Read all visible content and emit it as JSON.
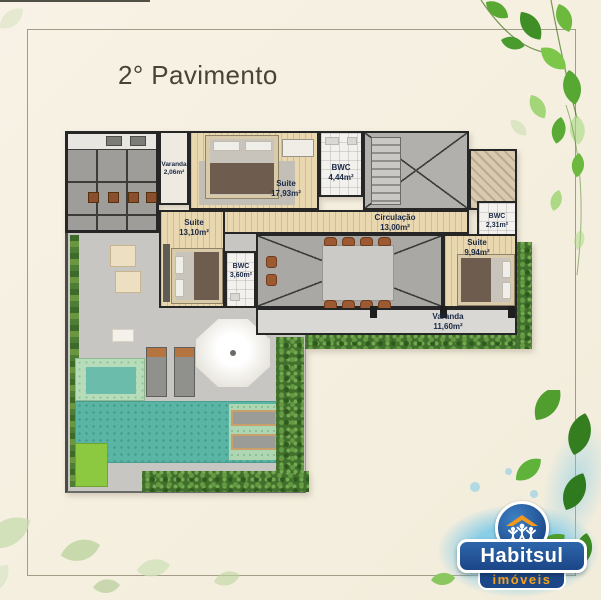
{
  "title": "2° Pavimento",
  "plan": {
    "rooms": [
      {
        "id": "varanda-small",
        "name": "Varanda",
        "area": "2,06m²"
      },
      {
        "id": "suite-master",
        "name": "Suite",
        "area": "17,93m²"
      },
      {
        "id": "bwc-master",
        "name": "BWC",
        "area": "4,44m²"
      },
      {
        "id": "suite-left",
        "name": "Suite",
        "area": "13,10m²"
      },
      {
        "id": "circulacao",
        "name": "Circulação",
        "area": "13,00m²"
      },
      {
        "id": "bwc-small",
        "name": "BWC",
        "area": "2,31m²"
      },
      {
        "id": "suite-right",
        "name": "Suite",
        "area": "9,94m²"
      },
      {
        "id": "bwc-left",
        "name": "BWC",
        "area": "3,60m²"
      },
      {
        "id": "varanda-large",
        "name": "Varanda",
        "area": "11,60m²"
      }
    ]
  },
  "logo": {
    "brand": "Habitsul",
    "tagline": "imóveis"
  },
  "colors": {
    "background": "#f7f1e3",
    "wall": "#262626",
    "wood_floor": "#e9d7b0",
    "pool_teal": "#5ab5a4",
    "label_navy": "#1a2844",
    "logo_blue": "#1b4687",
    "logo_orange": "#f6a21c",
    "leaf_green": "#4f9e2e"
  }
}
